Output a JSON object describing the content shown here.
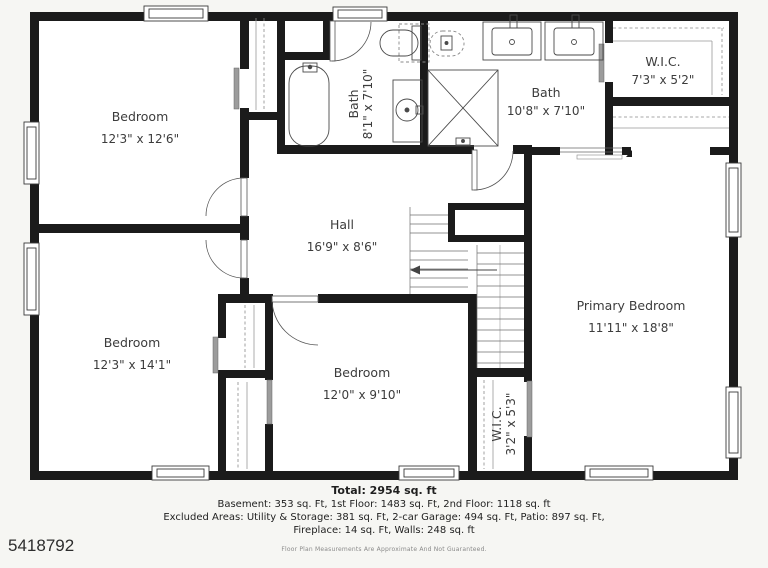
{
  "listing_id": "5418792",
  "rooms": {
    "bedroom1": {
      "name": "Bedroom",
      "dims": "12'3\" x 12'6\""
    },
    "bedroom2": {
      "name": "Bedroom",
      "dims": "12'3\" x 14'1\""
    },
    "bedroom3": {
      "name": "Bedroom",
      "dims": "12'0\" x 9'10\""
    },
    "primary": {
      "name": "Primary Bedroom",
      "dims": "11'11\" x 18'8\""
    },
    "hall": {
      "name": "Hall",
      "dims": "16'9\" x 8'6\""
    },
    "bath1": {
      "name": "Bath",
      "dims": "8'1\" x 7'10\""
    },
    "bath2": {
      "name": "Bath",
      "dims": "10'8\" x 7'10\""
    },
    "wic1": {
      "name": "W.I.C.",
      "dims": "7'3\" x 5'2\""
    },
    "wic2": {
      "name": "W.I.C.",
      "dims": "3'2\" x 5'3\""
    }
  },
  "summary": {
    "total": "Total: 2954 sq. ft",
    "line1": "Basement: 353 sq. Ft, 1st Floor: 1483 sq. Ft, 2nd Floor: 1118 sq. ft",
    "line2": "Excluded Areas: Utility & Storage: 381 sq. Ft, 2-car Garage: 494 sq. Ft, Patio: 897 sq. Ft,",
    "line3": "Fireplace: 14 sq. Ft, Walls: 248 sq. ft",
    "disclaimer": "Floor Plan Measurements Are Approximate And Not Guaranteed."
  },
  "colors": {
    "wall": "#1b1b1b",
    "floor": "#ffffff",
    "page_background": "#f6f6f3",
    "sliding_door": "#9c9c9c",
    "label_text": "#3c3c3c"
  }
}
